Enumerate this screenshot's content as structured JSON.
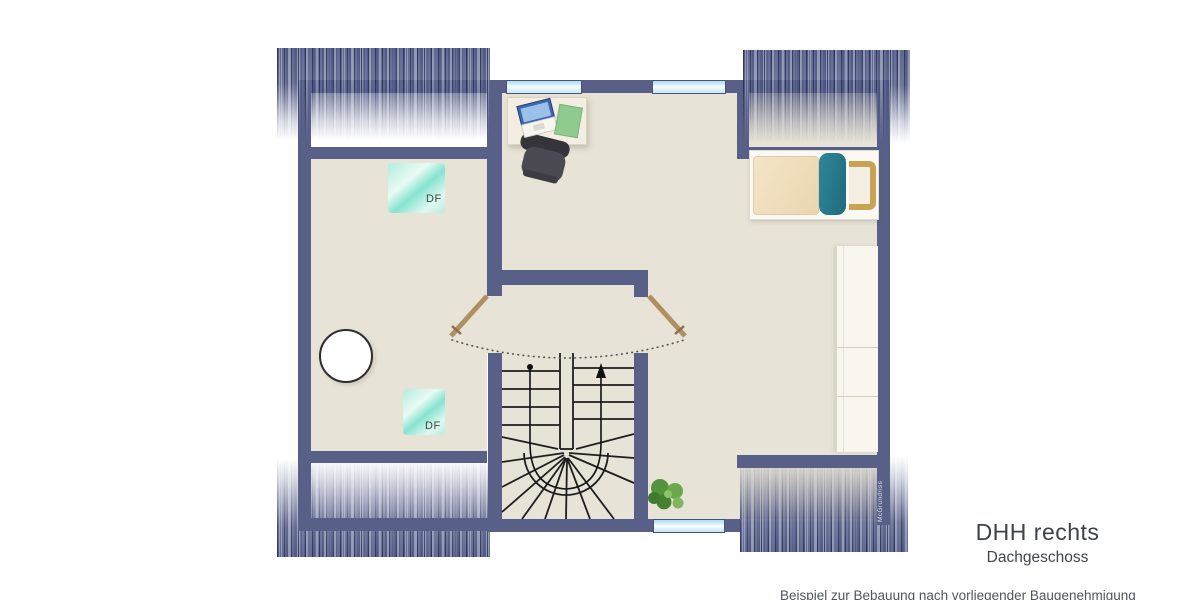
{
  "title": {
    "line1": "DHH rechts",
    "line2": "Dachgeschoss"
  },
  "caption": "Beispiel zur Bebauung nach vorliegender Baugenehmigung",
  "watermark": "McGrundriss",
  "labels": {
    "skylight1": "DF",
    "skylight2": "DF"
  },
  "colors": {
    "wall": "#586088",
    "floor": "#e8e3d7",
    "roof_hatch": "#4a5280",
    "window_glass": "#c4e6f2",
    "skylight_teal": "#7fe3cf",
    "bed_pillow_teal": "#2f8699",
    "headboard_tan": "#c9a254",
    "door_leaf_tan": "#b08f60",
    "laptop_blue": "#3a67b8",
    "notepad_green": "#8fca8f",
    "plant_green": "#56933d",
    "title_text": "#3d4248"
  }
}
